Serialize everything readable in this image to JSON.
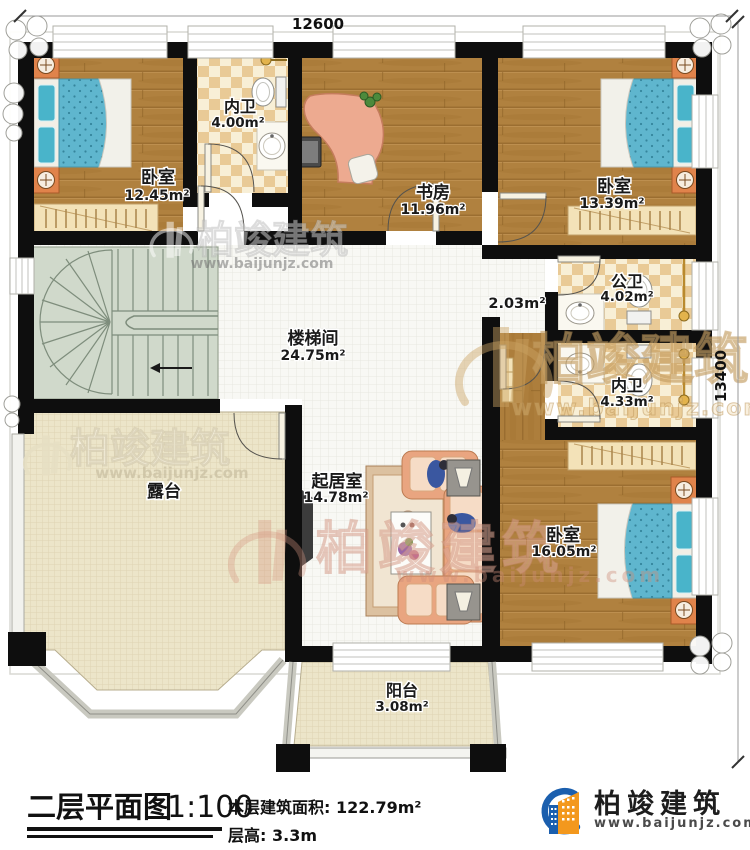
{
  "plan": {
    "dimensions": {
      "top": "12600",
      "right": "13400"
    },
    "rooms": {
      "bedroom1": {
        "name": "卧室",
        "area": "12.45m²"
      },
      "bath1": {
        "name": "内卫",
        "area": "4.00m²"
      },
      "study": {
        "name": "书房",
        "area": "11.96m²"
      },
      "bedroom2": {
        "name": "卧室",
        "area": "13.39m²"
      },
      "public_bath": {
        "name": "公卫",
        "area": "4.02m²"
      },
      "hall_nook": {
        "area": "2.03m²"
      },
      "bath2": {
        "name": "内卫",
        "area": "4.33m²"
      },
      "stairwell": {
        "name": "楼梯间",
        "area": "24.75m²"
      },
      "terrace": {
        "name": "露台"
      },
      "living": {
        "name": "起居室",
        "area": "14.78m²"
      },
      "bedroom3": {
        "name": "卧室",
        "area": "16.05m²"
      },
      "balcony": {
        "name": "阳台",
        "area": "3.08m²"
      }
    }
  },
  "footer": {
    "plan_title": "二层平面图",
    "scale": "1:100",
    "area_label": "本层建筑面积:",
    "area_value": "122.79m²",
    "height_label": "层高:",
    "height_value": "3.3m"
  },
  "brand": {
    "name": "柏竣建筑",
    "website": "www.baijunjz.com"
  },
  "watermark": {
    "name": "柏竣建筑",
    "website": "www.baijunjz.com"
  },
  "colors": {
    "wall": "#0e0e0e",
    "wood_floor": "#b0813f",
    "bath_tile_dark": "#e9ca96",
    "bath_tile_light": "#f8efd6",
    "hall_tile": "#f8f8f4",
    "outdoor_tile": "#ece5c9",
    "stairs": "#d0d9cb",
    "bed_blue": "#5fb6ce",
    "furniture_orange": "#e0834b",
    "sofa_salmon": "#e9a580",
    "logo_blue": "#1b5fae",
    "logo_orange": "#f3981d"
  }
}
